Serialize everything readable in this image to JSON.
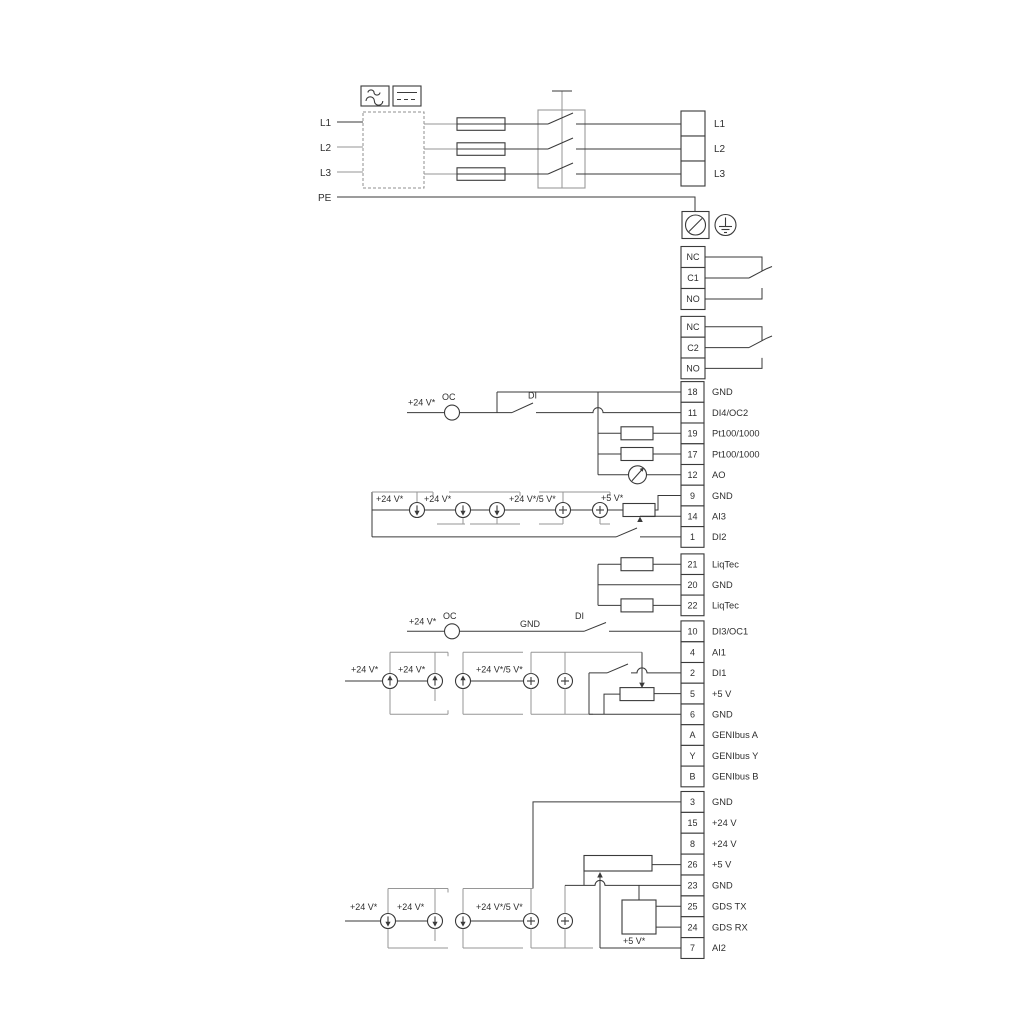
{
  "power_input": [
    "L1",
    "L2",
    "L3",
    "PE"
  ],
  "labels": {
    "v24": "+24 V*",
    "v24_5": "+24 V*/5 V*",
    "v5": "+5 V*",
    "oc": "OC",
    "di": "DI",
    "gnd": "GND"
  },
  "terminal_groups": {
    "lblock": {
      "rows": [
        {
          "label": "L1"
        },
        {
          "label": "L2"
        },
        {
          "label": "L3"
        }
      ]
    },
    "relay1": {
      "rows": [
        {
          "cell": "NC"
        },
        {
          "cell": "C1"
        },
        {
          "cell": "NO"
        }
      ]
    },
    "relay2": {
      "rows": [
        {
          "cell": "NC"
        },
        {
          "cell": "C2"
        },
        {
          "cell": "NO"
        }
      ]
    },
    "io1": {
      "rows": [
        {
          "num": "18",
          "label": "GND"
        },
        {
          "num": "11",
          "label": "DI4/OC2"
        },
        {
          "num": "19",
          "label": "Pt100/1000"
        },
        {
          "num": "17",
          "label": "Pt100/1000"
        },
        {
          "num": "12",
          "label": "AO"
        },
        {
          "num": "9",
          "label": "GND"
        },
        {
          "num": "14",
          "label": "AI3"
        },
        {
          "num": "1",
          "label": "DI2"
        }
      ]
    },
    "liqtec": {
      "rows": [
        {
          "num": "21",
          "label": "LiqTec"
        },
        {
          "num": "20",
          "label": "GND"
        },
        {
          "num": "22",
          "label": "LiqTec"
        }
      ]
    },
    "di3": {
      "rows": [
        {
          "num": "10",
          "label": "DI3/OC1"
        }
      ]
    },
    "io2": {
      "rows": [
        {
          "num": "4",
          "label": "AI1"
        },
        {
          "num": "2",
          "label": "DI1"
        },
        {
          "num": "5",
          "label": "+5 V"
        },
        {
          "num": "6",
          "label": "GND"
        },
        {
          "num": "A",
          "label": "GENIbus A"
        },
        {
          "num": "Y",
          "label": "GENIbus Y"
        },
        {
          "num": "B",
          "label": "GENIbus B"
        }
      ]
    },
    "io3": {
      "rows": [
        {
          "num": "3",
          "label": "GND"
        },
        {
          "num": "15",
          "label": "+24 V"
        },
        {
          "num": "8",
          "label": "+24 V"
        },
        {
          "num": "26",
          "label": "+5 V"
        },
        {
          "num": "23",
          "label": "GND"
        },
        {
          "num": "25",
          "label": "GDS TX"
        },
        {
          "num": "24",
          "label": "GDS RX"
        },
        {
          "num": "7",
          "label": "AI2"
        }
      ]
    }
  }
}
